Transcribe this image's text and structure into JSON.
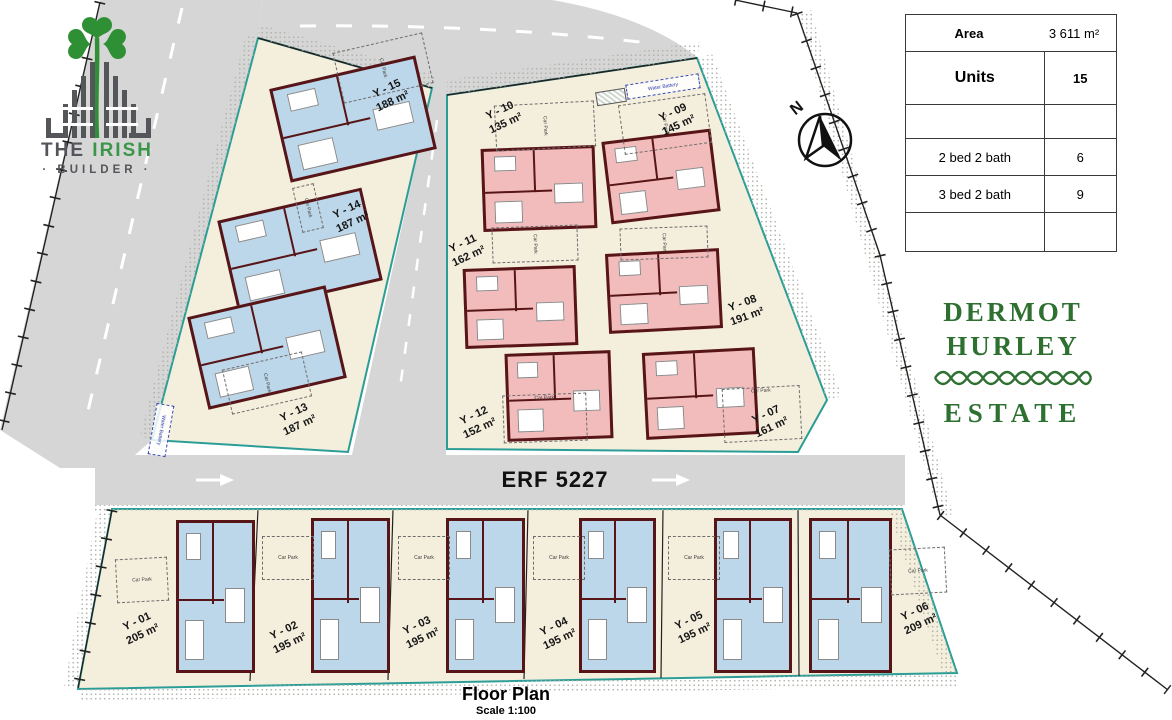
{
  "branding": {
    "builder_logo": {
      "word_the": "THE",
      "word_irish": "IRISH",
      "word_builder": "· BUILDER ·"
    },
    "estate_name": {
      "line1": "DERMOT",
      "line2": "HURLEY",
      "line3": "ESTATE"
    }
  },
  "summary_table": {
    "area_label": "Area",
    "area_value": "3 611 m²",
    "units_label": "Units",
    "units_value": "15",
    "rows": [
      {
        "label": "2 bed 2 bath",
        "value": "6"
      },
      {
        "label": "3 bed 2 bath",
        "value": "9"
      }
    ]
  },
  "compass": {
    "north_label": "N"
  },
  "road": {
    "name": "ERF 5227"
  },
  "title": {
    "heading": "Floor Plan",
    "scale": "Scale 1:100"
  },
  "labels": {
    "car_park": "Car Park",
    "water_battery": "Water Battery"
  },
  "units": [
    {
      "id": "Y - 01",
      "area": "205 m²"
    },
    {
      "id": "Y - 02",
      "area": "195 m²"
    },
    {
      "id": "Y - 03",
      "area": "195 m²"
    },
    {
      "id": "Y - 04",
      "area": "195 m²"
    },
    {
      "id": "Y - 05",
      "area": "195 m²"
    },
    {
      "id": "Y - 06",
      "area": "209 m²"
    },
    {
      "id": "Y - 07",
      "area": "161 m²"
    },
    {
      "id": "Y - 08",
      "area": "191 m²"
    },
    {
      "id": "Y - 09",
      "area": "145 m²"
    },
    {
      "id": "Y - 10",
      "area": "135 m²"
    },
    {
      "id": "Y - 11",
      "area": "162 m²"
    },
    {
      "id": "Y - 12",
      "area": "152 m²"
    },
    {
      "id": "Y - 13",
      "area": "187 m²"
    },
    {
      "id": "Y - 14",
      "area": "187 m²"
    },
    {
      "id": "Y - 15",
      "area": "188 m²"
    }
  ]
}
